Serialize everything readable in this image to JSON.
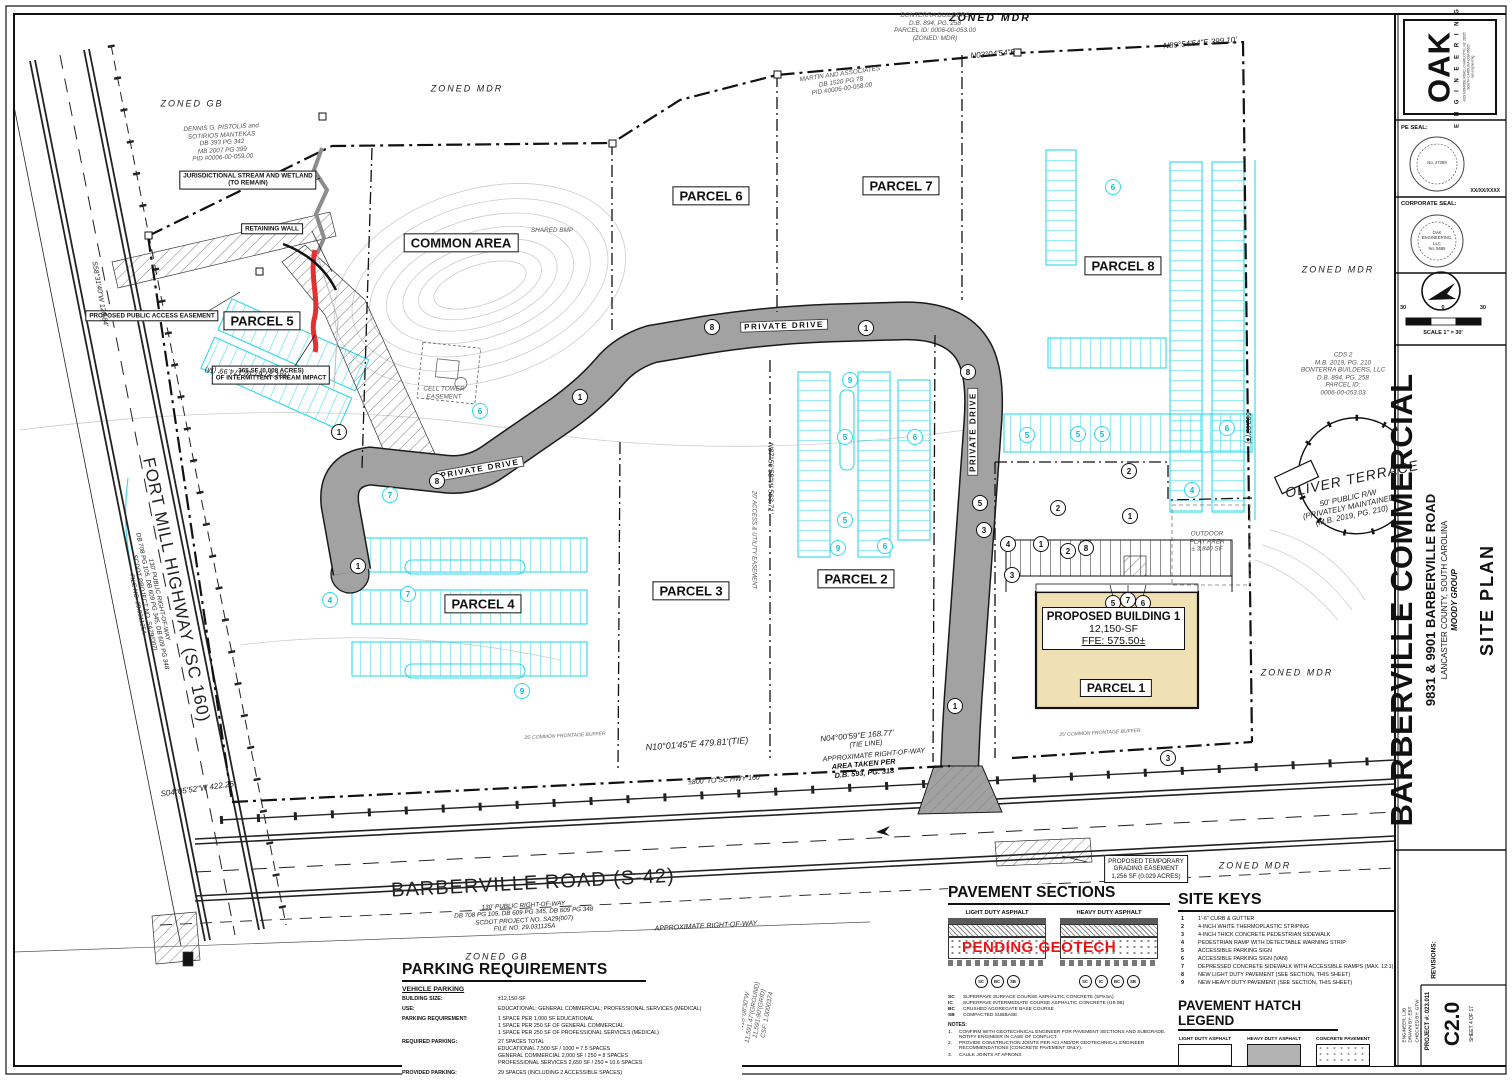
{
  "sheet": {
    "titleblock": {
      "logo": {
        "word": "OAK",
        "sub": "E N G I N E E R I N G",
        "addr1": "4029 MONROE ROAD, CHARLOTTE, NC 28205",
        "addr2": "SOUTH CAROLINA COA #6605",
        "addr3": "oak.engineering"
      },
      "pe_seal_label": "PE SEAL:",
      "pe_seal_no": "No. 27389",
      "seal_date": "XX/XX/XXXX",
      "corp_seal_label": "CORPORATE SEAL:",
      "corp_seal_lines": [
        "OAK",
        "ENGINEERING,",
        "LLC",
        "No. 5685"
      ],
      "scale": {
        "left": "30",
        "mid": "0",
        "right": "30",
        "caption": "SCALE 1\" = 30'"
      },
      "project": {
        "title": "BARBERVILLE COMMERCIAL",
        "address": "9831 & 9901 BARBERVILLE ROAD",
        "county": "LANCASTER COUNTY, SOUTH CAROLINA",
        "client": "MOODY GROUP",
        "sheet_title": "SITE PLAN"
      },
      "revisions_label": "REVISIONS:",
      "credits": [
        "ENGINEER: LJB",
        "DRAWN BY: EBT",
        "CHECKED BY: GTW"
      ],
      "project_no": "PROJECT #: 023.011",
      "sheet_no": "C2.0",
      "sheet_of": "SHEET 4 OF 17"
    }
  },
  "plan": {
    "building": {
      "l1": "PROPOSED BUILDING 1",
      "l2": "12,150-SF",
      "l3": "FFE: 575.50±",
      "parcel": "PARCEL 1"
    },
    "colors": {
      "cyan": "#2fd8ea",
      "road_gray": "#a2a2a2",
      "building_tan": "#f0e1b4",
      "alert_red": "#ee1111"
    },
    "labels": [
      {
        "name": "parcel-5-label",
        "t": "PARCEL 5",
        "x": 262,
        "y": 321,
        "cls": "parcel"
      },
      {
        "name": "common-area-label",
        "t": "COMMON AREA",
        "x": 461,
        "y": 243,
        "cls": "parcel"
      },
      {
        "name": "parcel-6-label",
        "t": "PARCEL 6",
        "x": 711,
        "y": 196,
        "cls": "parcel"
      },
      {
        "name": "parcel-7-label",
        "t": "PARCEL 7",
        "x": 901,
        "y": 186,
        "cls": "parcel"
      },
      {
        "name": "parcel-8-label",
        "t": "PARCEL 8",
        "x": 1123,
        "y": 266,
        "cls": "parcel"
      },
      {
        "name": "parcel-4-label",
        "t": "PARCEL 4",
        "x": 483,
        "y": 604,
        "cls": "parcel"
      },
      {
        "name": "parcel-3-label",
        "t": "PARCEL 3",
        "x": 691,
        "y": 591,
        "cls": "parcel"
      },
      {
        "name": "parcel-2-label",
        "t": "PARCEL 2",
        "x": 856,
        "y": 579,
        "cls": "parcel"
      },
      {
        "name": "stream-wetland-note",
        "ls": [
          "JURISDICTIONAL STREAM AND WETLAND",
          "(TO REMAIN)"
        ],
        "x": 248,
        "y": 180,
        "cls": "ann"
      },
      {
        "name": "retaining-wall-note",
        "t": "RETAINING WALL",
        "x": 272,
        "y": 229,
        "cls": "ann"
      },
      {
        "name": "public-access-easement-note",
        "t": "PROPOSED PUBLIC ACCESS EASEMENT",
        "x": 152,
        "y": 316,
        "cls": "ann"
      },
      {
        "name": "stream-impact-note",
        "ls": [
          "365 SF (0.008 ACRES)",
          "OF INTERMITTENT STREAM IMPACT"
        ],
        "x": 271,
        "y": 375,
        "cls": "ann"
      },
      {
        "name": "grading-easement-note",
        "ls": [
          "PROPOSED TEMPORARY",
          "GRADING EASEMENT",
          "1,256 SF (0.029 ACRES)"
        ],
        "x": 1146,
        "y": 869,
        "cls": "ann3"
      },
      {
        "name": "private-drive-label-1",
        "t": "PRIVATE DRIVE",
        "x": 784,
        "y": 326,
        "cls": "drive",
        "rot": -2
      },
      {
        "name": "private-drive-label-2",
        "t": "PRIVATE DRIVE",
        "x": 480,
        "y": 469,
        "cls": "drive",
        "rot": -10
      },
      {
        "name": "private-drive-label-3",
        "t": "PRIVATE DRIVE",
        "x": 973,
        "y": 432,
        "cls": "drive",
        "rot": -90
      },
      {
        "name": "barberville-road-label",
        "t": "BARBERVILLE ROAD (S-42)",
        "x": 533,
        "y": 884,
        "cls": "road",
        "rot": -3
      },
      {
        "name": "barberville-road-sub",
        "ls": [
          "130' PUBLIC RIGHT-OF-WAY",
          "DB 708 PG 105, DB 609 PG 345, DB 609 PG 348",
          "SCDOT PROJECT NO. SA29(007)",
          "FILE NO. 29.031125A"
        ],
        "x": 524,
        "y": 917,
        "cls": "roadsub",
        "rot": -3
      },
      {
        "name": "fort-mill-highway-label",
        "t": "FORT MILL HIGHWAY (SC 160)",
        "x": 176,
        "y": 590,
        "cls": "road",
        "rot": 78,
        "fs": 17
      },
      {
        "name": "fort-mill-highway-sub",
        "ls": [
          "130' PUBLIC RIGHT-OF-WAY",
          "DB 708 PG 105, DB 609 PG 345, DB 609 PG 348",
          "SCDOT PROJECT NO. SA29(007)",
          "FILE NO. 29.031125A"
        ],
        "x": 148,
        "y": 602,
        "cls": "roadsub",
        "rot": 78
      },
      {
        "name": "zoned-gb-nw",
        "t": "ZONED GB",
        "x": 192,
        "y": 104,
        "cls": "zone"
      },
      {
        "name": "zoned-mdr-n1",
        "t": "ZONED MDR",
        "x": 467,
        "y": 89,
        "cls": "zone"
      },
      {
        "name": "zoned-mdr-top",
        "t": "ZONED MDR",
        "x": 990,
        "y": 18,
        "cls": "zoneb"
      },
      {
        "name": "zoned-mdr-e1",
        "t": "ZONED MDR",
        "x": 1338,
        "y": 270,
        "cls": "zone"
      },
      {
        "name": "zoned-mdr-e2",
        "t": "ZONED MDR",
        "x": 1297,
        "y": 673,
        "cls": "zone"
      },
      {
        "name": "zoned-mdr-se",
        "t": "ZONED MDR",
        "x": 1255,
        "y": 866,
        "cls": "zone"
      },
      {
        "name": "zoned-gb-s",
        "t": "ZONED GB",
        "x": 497,
        "y": 957,
        "cls": "zone"
      },
      {
        "name": "owner-pistolis",
        "ls": [
          "DENNIS G. PISTOLIS and",
          "SOTIRIOS MANTEKAS",
          "DB 393 PG 342",
          "MB 2007 PG 399",
          "PID #0006-00-059.00"
        ],
        "x": 222,
        "y": 143,
        "cls": "own",
        "rot": -3
      },
      {
        "name": "owner-bonterra-top",
        "ls": [
          "BONTERRA BUILDERS",
          "D.B. 894, PG. 258",
          "PARCEL ID: 0006-00-053.00",
          "(ZONED: MDR)"
        ],
        "x": 935,
        "y": 27,
        "cls": "own"
      },
      {
        "name": "owner-martin",
        "ls": [
          "MARTIN AND ASSOCIATES",
          "DB 1520 PG 78",
          "PID #0006-00-058.00"
        ],
        "x": 841,
        "y": 82,
        "cls": "own",
        "rot": -8
      },
      {
        "name": "owner-cds2",
        "ls": [
          "CDS 2",
          "M.B. 2019, PG. 210",
          "BONTERRA BUILDERS, LLC",
          "D.B. 894, PG. 258",
          "PARCEL ID:",
          "0006-00-053.03"
        ],
        "x": 1343,
        "y": 374,
        "cls": "own"
      },
      {
        "name": "oliver-terrace-label",
        "t": "OLIVER TERRACE",
        "x": 1352,
        "y": 479,
        "cls": "oliver",
        "rot": -12
      },
      {
        "name": "oliver-terrace-sub",
        "ls": [
          "50' PUBLIC R/W",
          "(PRIVATELY MAINTAINED)",
          "(M.B. 2019, PG. 210)"
        ],
        "x": 1350,
        "y": 507,
        "cls": "own8",
        "rot": -12
      },
      {
        "name": "cell-tower-easement",
        "ls": [
          "CELL TOWER",
          "EASEMENT"
        ],
        "x": 444,
        "y": 393,
        "cls": "own"
      },
      {
        "name": "shared-bmp",
        "t": "SHARED BMP",
        "x": 552,
        "y": 231,
        "cls": "own"
      },
      {
        "name": "outdoor-play-area",
        "ls": [
          "OUTDOOR",
          "PLAY AREA",
          "± 3,840 SF"
        ],
        "x": 1207,
        "y": 542,
        "cls": "own"
      },
      {
        "name": "bearing-tie",
        "t": "N10°01'45\"E   479.81'(TIE)",
        "x": 697,
        "y": 744,
        "cls": "bear",
        "rot": -4,
        "fs": 9
      },
      {
        "name": "bearing-168",
        "t": "N04°00'59\"E   168.77'",
        "x": 857,
        "y": 736,
        "cls": "bear",
        "rot": -5
      },
      {
        "name": "tie-line-note",
        "t": "(TIE LINE)",
        "x": 866,
        "y": 745,
        "cls": "bear",
        "rot": -5,
        "fs": 7
      },
      {
        "name": "approx-row-1",
        "t": "APPROXIMATE RIGHT-OF-WAY",
        "x": 874,
        "y": 756,
        "cls": "bear",
        "rot": -5,
        "fs": 7
      },
      {
        "name": "area-taken-note",
        "ls": [
          "AREA TAKEN PER",
          "D.B. 593, PG. 318"
        ],
        "x": 864,
        "y": 769,
        "cls": "bearb",
        "rot": -5
      },
      {
        "name": "hwy160-note",
        "t": "±800' TO SC HWY 160",
        "x": 724,
        "y": 781,
        "cls": "bear",
        "rot": -4,
        "fs": 7
      },
      {
        "name": "bearing-422",
        "t": "S04°05'52\"W  422.25'",
        "x": 198,
        "y": 789,
        "cls": "bear",
        "rot": -8
      },
      {
        "name": "approx-row-2",
        "t": "APPROXIMATE RIGHT-OF-WAY",
        "x": 706,
        "y": 927,
        "cls": "bear",
        "rot": -3,
        "fs": 7
      },
      {
        "name": "bearing-399",
        "t": "N89°54'54\"E  399.10'",
        "x": 1200,
        "y": 43,
        "cls": "bear",
        "rot": -5
      },
      {
        "name": "bearing-n03",
        "t": "N03°04'54\"E",
        "x": 993,
        "y": 54,
        "cls": "bear",
        "rot": -5
      },
      {
        "name": "bearing-174",
        "t": "N01°27'57\"W  174.99' (M)",
        "x": 247,
        "y": 372,
        "cls": "bear",
        "rot": 184,
        "fs": 7.5
      },
      {
        "name": "bearing-120",
        "t": "S58°31'40\"W  120.84'",
        "x": 99,
        "y": 294,
        "cls": "bear",
        "rot": 80,
        "fs": 7
      },
      {
        "name": "bearing-563",
        "t": "N87°56'58\"W  563.71'",
        "x": 770,
        "y": 478,
        "cls": "bear",
        "rot": 90,
        "fs": 7.5
      },
      {
        "name": "access-utility-easement",
        "t": "20' ACCESS & UTILITY EASEMENT",
        "x": 753,
        "y": 540,
        "cls": "own",
        "rot": 90,
        "fs": 6
      },
      {
        "name": "bearing-602",
        "t": "602.92'(T)",
        "x": 1247,
        "y": 428,
        "cls": "bear",
        "rot": 90,
        "fs": 7
      },
      {
        "name": "grid-block",
        "ls": [
          "N18°08'30\"W",
          "11,591.47'(GROUND)",
          "11,591.90'(GRID)",
          "CSF: 1.0000374"
        ],
        "x": 756,
        "y": 1013,
        "cls": "own",
        "rot": -80
      },
      {
        "name": "tie-block",
        "ls": [
          "N00°49'04\"E",
          "11088.81' (GRID)",
          "TIE LINE - NTS"
        ],
        "x": 700,
        "y": 991,
        "cls": "own8",
        "rot": -14
      },
      {
        "name": "frontage-buffer-1",
        "t": "25' COMMON FRONTAGE BUFFER",
        "x": 1100,
        "y": 734,
        "cls": "tiny",
        "rot": -3
      },
      {
        "name": "frontage-buffer-2",
        "t": "25' COMMON FRONTAGE BUFFER",
        "x": 565,
        "y": 737,
        "cls": "tiny",
        "rot": -3
      }
    ],
    "keys_black": [
      [
        1,
        580,
        397
      ],
      [
        8,
        437,
        481
      ],
      [
        8,
        712,
        327
      ],
      [
        1,
        866,
        328
      ],
      [
        8,
        968,
        372
      ],
      [
        1,
        339,
        432
      ],
      [
        1,
        358,
        566
      ],
      [
        1,
        955,
        706
      ],
      [
        3,
        1168,
        758
      ],
      [
        2,
        1129,
        471
      ],
      [
        2,
        1058,
        508
      ],
      [
        1,
        1130,
        516
      ],
      [
        4,
        1008,
        544
      ],
      [
        1,
        1041,
        544
      ],
      [
        2,
        1068,
        551
      ],
      [
        8,
        1086,
        548
      ],
      [
        3,
        1012,
        575
      ],
      [
        5,
        1113,
        603
      ],
      [
        7,
        1128,
        600
      ],
      [
        6,
        1143,
        603
      ],
      [
        5,
        980,
        503
      ],
      [
        3,
        984,
        530
      ]
    ],
    "keys_cyan": [
      [
        5,
        1027,
        435
      ],
      [
        5,
        1078,
        434
      ],
      [
        5,
        1102,
        434
      ],
      [
        6,
        1227,
        428
      ],
      [
        4,
        1192,
        490
      ],
      [
        9,
        850,
        380
      ],
      [
        5,
        845,
        437
      ],
      [
        6,
        915,
        437
      ],
      [
        5,
        845,
        520
      ],
      [
        9,
        838,
        548
      ],
      [
        6,
        885,
        546
      ],
      [
        7,
        390,
        495
      ],
      [
        4,
        330,
        600
      ],
      [
        7,
        408,
        594
      ],
      [
        9,
        522,
        691
      ],
      [
        6,
        480,
        411
      ],
      [
        6,
        1113,
        187
      ]
    ]
  },
  "panels": {
    "parking": {
      "title": "PARKING REQUIREMENTS",
      "subtitle": "VEHICLE PARKING",
      "rows": [
        {
          "label": "BUILDING SIZE:",
          "lines": [
            "±12,150-SF"
          ]
        },
        {
          "label": "USE:",
          "lines": [
            "EDUCATIONAL; GENERAL COMMERCIAL; PROFESSIONAL SERVICES (MEDICAL)"
          ]
        },
        {
          "label": "PARKING REQUIREMENT:",
          "lines": [
            "1 SPACE PER 1,000 SF EDUCATIONAL",
            "1 SPACE PER 250 SF OF GENERAL COMMERCIAL",
            "1 SPACE PER 250 SF OF PROFESSIONAL SERVICES (MEDICAL)"
          ]
        },
        {
          "label": "REQUIRED PARKING:",
          "lines": [
            "27 SPACES TOTAL",
            "EDUCATIONAL 7,500 SF / 1000 = 7.5 SPACES",
            "GENERAL COMMERCIAL 2,000 SF / 250 = 8 SPACES",
            "PROFESSIONAL SERVICES 2,650 SF / 250 = 10.6 SPACES"
          ]
        },
        {
          "label": "PROVIDED PARKING:",
          "lines": [
            "29 SPACES (INCLUDING 2 ACCESSIBLE SPACES)"
          ]
        }
      ]
    },
    "pavement": {
      "title": "PAVEMENT SECTIONS",
      "left_caption": "LIGHT DUTY ASPHALT",
      "right_caption": "HEAVY DUTY ASPHALT",
      "overlay": "PENDING GEOTECH",
      "left_tags": [
        "SC",
        "BC",
        "SB"
      ],
      "right_tags": [
        "SC",
        "IC",
        "BC",
        "SB"
      ],
      "materials": [
        [
          "SC",
          "SUPERPAVE SURFACE COURSE ASPHALTIC CONCRETE (SF9.5A)"
        ],
        [
          "IC",
          "SUPERPAVE INTERMEDIATE COURSE ASPHALTIC CONCRETE (I19.0B)"
        ],
        [
          "BC",
          "CRUSHED AGGREGATE BASE COURSE"
        ],
        [
          "SB",
          "COMPACTED SUBBASE"
        ]
      ],
      "notes_label": "NOTES:",
      "notes": [
        "CONFIRM WITH GEOTECHNICAL ENGINEER FOR PAVEMENT SECTIONS AND SUBGRADE. NOTIFY ENGINEER IN CASE OF CONFLICT.",
        "PROVIDE CONSTRUCTION JOINTS PER ACI AND/OR GEOTECHNICAL ENGINEER RECOMMENDATIONS (CONCRETE PAVEMENT ONLY).",
        "CAULK JOINTS AT APRONS"
      ]
    },
    "site_keys": {
      "title": "SITE KEYS",
      "items": [
        "1'-6\" CURB & GUTTER",
        "4-INCH WHITE THERMOPLASTIC STRIPING",
        "4-INCH THICK CONCRETE PEDESTRIAN SIDEWALK",
        "PEDESTRIAN RAMP WITH DETECTABLE WARNING STRIP",
        "ACCESSIBLE PARKING SIGN",
        "ACCESSIBLE PARKING SIGN (VAN)",
        "DEPRESSED CONCRETE SIDEWALK WITH ACCESSIBLE RAMPS (MAX. 12:1)",
        "NEW LIGHT DUTY PAVEMENT (SEE SECTION, THIS SHEET)",
        "NEW HEAVY DUTY PAVEMENT (SEE SECTION, THIS SHEET)"
      ]
    },
    "hatch_legend": {
      "title": "PAVEMENT HATCH LEGEND",
      "items": [
        {
          "label": "LIGHT DUTY ASPHALT",
          "style": "light"
        },
        {
          "label": "HEAVY DUTY ASPHALT",
          "style": "heavy"
        },
        {
          "label": "CONCRETE PAVEMENT",
          "style": "conc"
        }
      ]
    }
  }
}
